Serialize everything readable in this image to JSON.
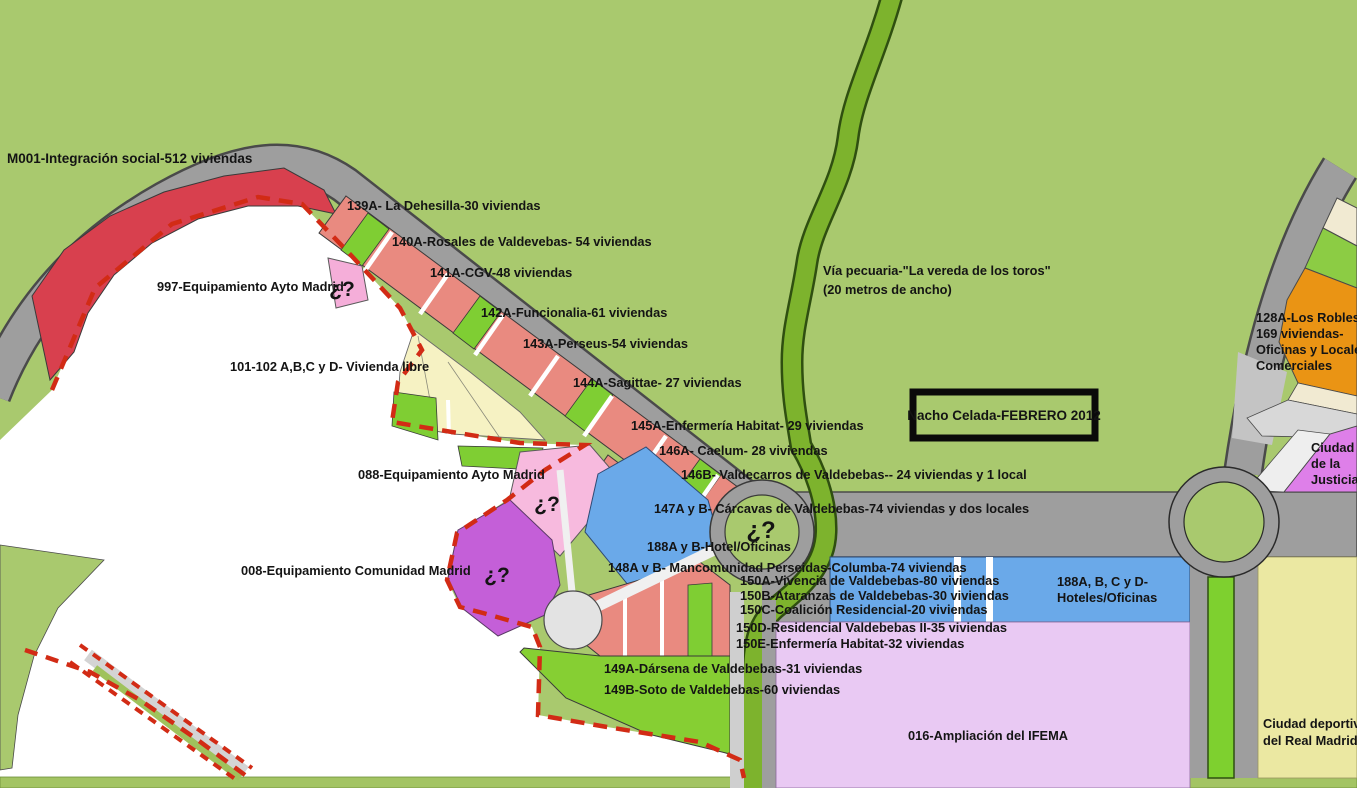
{
  "map_name": "Valdebebas development plan sketch",
  "author_box": {
    "text": "Nacho Celada-FEBRERO 2012"
  },
  "via_pecuaria": {
    "line1": "Vía pecuaria-\"La vereda de los toros\"",
    "line2": "(20 metros de ancho)"
  },
  "unknown_mark": "¿?",
  "parcels": {
    "m001": "M001-Integración social-512 viviendas",
    "p139a": "139A- La Dehesilla-30 viviendas",
    "p140a": "140A-Rosales de Valdevebas- 54 viviendas",
    "p141a": "141A-CGV-48 viviendas",
    "p142a": "142A-Funcionalia-61 viviendas",
    "p143a": "143A-Perseus-54 viviendas",
    "p144a": "144A-Sagittae- 27 viviendas",
    "p145a": "145A-Enfermería Habitat- 29 viviendas",
    "p146a": "146A- Caelum- 28 viviendas",
    "p146b": "146B- Valdecarros de Valdebebas-- 24 viviendas y 1 local",
    "p147ab": "147A y B- Cárcavas de Valdebebas-74 viviendas y dos locales",
    "p188ab": "188A y B-Hotel/Oficinas",
    "p148ab": "148A v B- Mancomunidad Perseidas-Columba-74 viviendas",
    "p150a": "150A-Vivencia de Valdebebas-80 viviendas",
    "p150b": "150B-Ataranzas de Valdebebas-30 viviendas",
    "p150c": "150C-Coalición Residencial-20 viviendas",
    "p150d": "150D-Residencial Valdebebas II-35 viviendas",
    "p150e": "150E-Enfermería Habitat-32 viviendas",
    "p149a": "149A-Dársena de Valdebebas-31 viviendas",
    "p149b": "149B-Soto de Valdebebas-60 viviendas",
    "p016": "016-Ampliación del IFEMA",
    "p997": "997-Equipamiento Ayto Madrid",
    "p101": "101-102 A,B,C y D- Vivienda libre",
    "p088": "088-Equipamiento Ayto Madrid",
    "p008": "008-Equipamiento Comunidad Madrid",
    "p128a": [
      "128A-Los Robles I-",
      "169 viviendas-",
      "Oficinas y Locales",
      "Comerciales"
    ],
    "justicia": [
      "Ciudad",
      "de la",
      "Justicia"
    ],
    "hoteles": [
      "188A, B, C y D-",
      "Hoteles/Oficinas"
    ],
    "real_madrid": [
      "Ciudad deportiva",
      "del Real Madrid"
    ]
  },
  "colors": {
    "background_green": "#a9c96e",
    "road_gray": "#9e9e9e",
    "road_edge": "#4a4a4a",
    "parcel_red": "#d8404e",
    "parcel_salmon": "#e98a80",
    "parcel_bright_green": "#7fce33",
    "via_pecuaria_green": "#7db32d",
    "parcel_cream": "#f6f2c3",
    "parcel_pink": "#f5aed9",
    "parcel_purple": "#c45fd8",
    "parcel_blue": "#6aa9e9",
    "ifema_lavender": "#e9c9f3",
    "sports_yellow": "#ebe8a2",
    "robles_orange": "#ea9414",
    "justicia_violet": "#de7fe9",
    "boundary_dashed_red": "#d22b15",
    "label_text": "#141414",
    "undeveloped_white": "#ffffff"
  }
}
